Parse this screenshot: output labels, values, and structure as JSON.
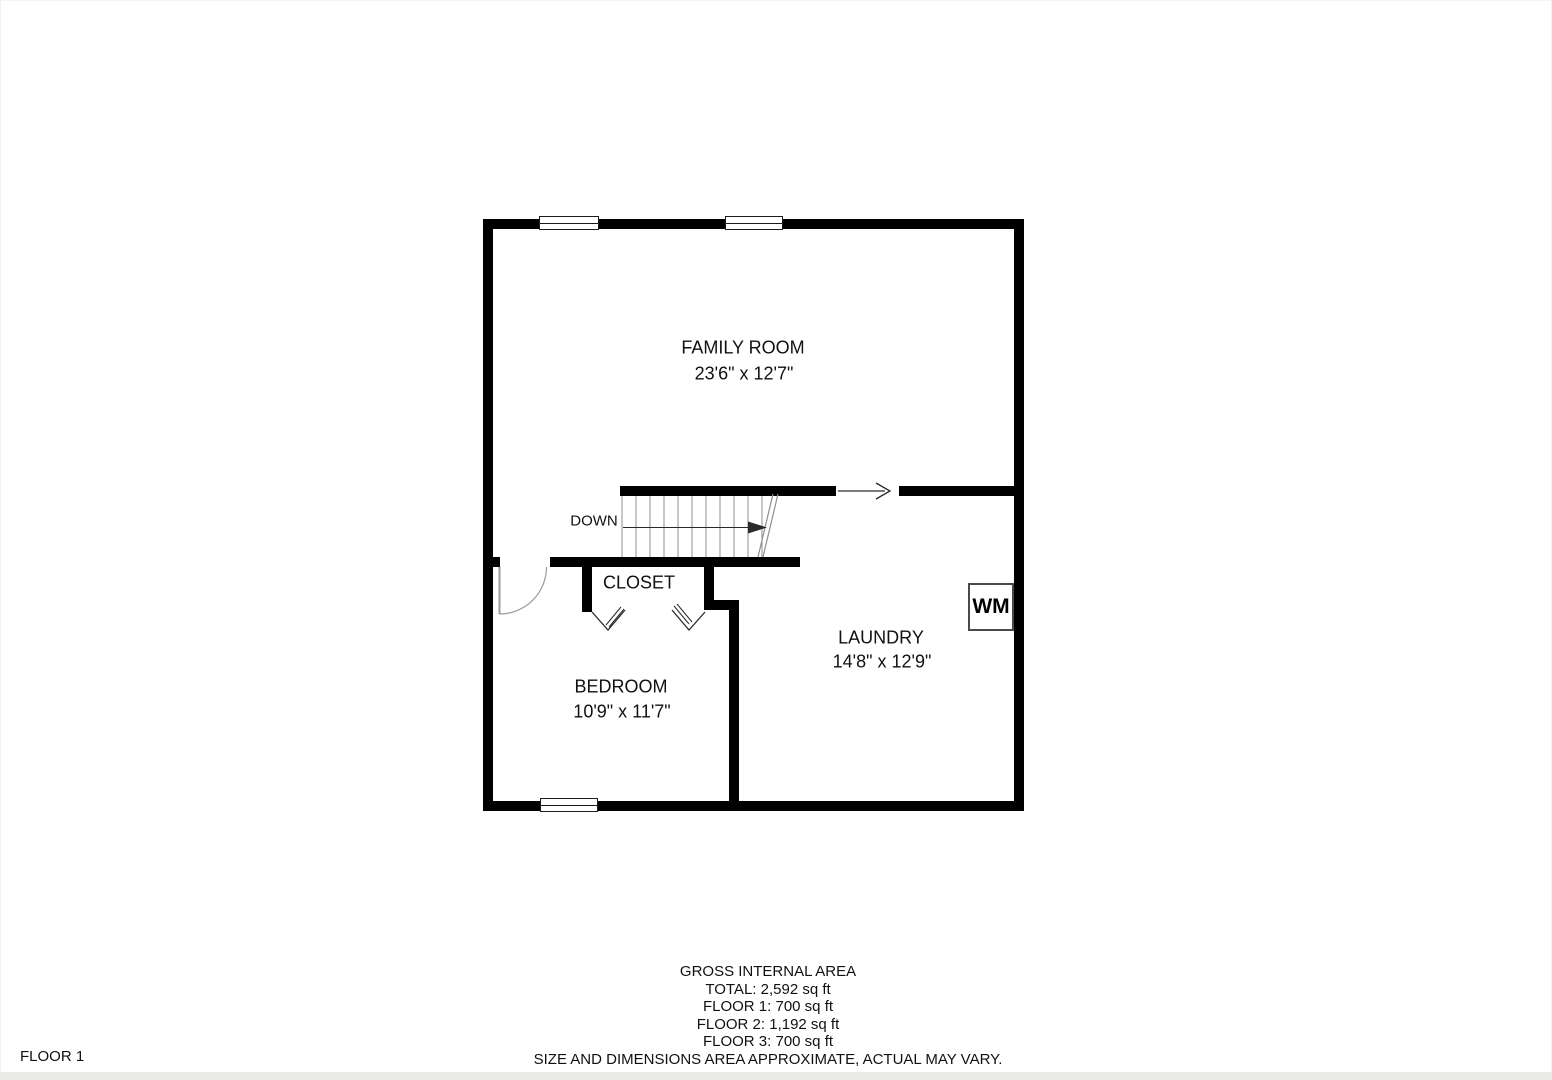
{
  "floor_label": "FLOOR 1",
  "rooms": {
    "family_room": {
      "name": "FAMILY ROOM",
      "dims": "23'6\" x 12'7\""
    },
    "closet": {
      "name": "CLOSET"
    },
    "bedroom": {
      "name": "BEDROOM",
      "dims": "10'9\" x 11'7\""
    },
    "laundry": {
      "name": "LAUNDRY",
      "dims": "14'8\" x 12'9\""
    }
  },
  "stairs": {
    "direction_label": "DOWN"
  },
  "appliances": {
    "washer_label": "WM"
  },
  "footer": {
    "heading": "GROSS INTERNAL AREA",
    "total": "TOTAL: 2,592 sq ft",
    "floor_1": "FLOOR 1: 700 sq ft",
    "floor_2": "FLOOR 2: 1,192 sq ft",
    "floor_3": "FLOOR 3: 700 sq ft",
    "disclaimer": "SIZE AND DIMENSIONS AREA APPROXIMATE, ACTUAL MAY VARY."
  },
  "colors": {
    "wall": "#000000",
    "thin": "#8f8f8f",
    "arrow": "#2a2a2a",
    "text": "#111111"
  }
}
